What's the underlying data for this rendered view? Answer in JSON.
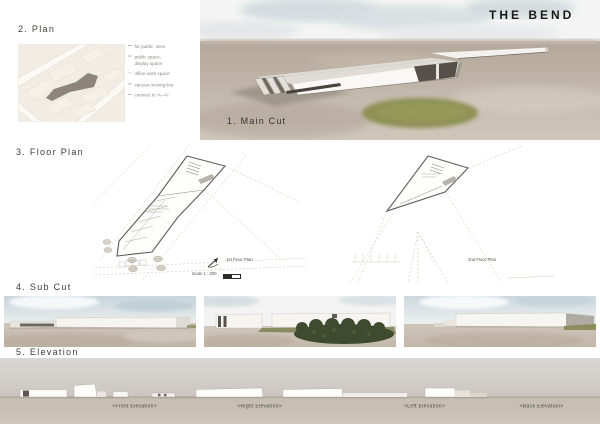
{
  "board_title": "THE BEND",
  "plan": {
    "heading": "2. Plan",
    "bullets": [
      "for public, semi",
      "public space, display space",
      "office work space",
      "various moving line",
      "connect to 'A—K'"
    ]
  },
  "main_cut": {
    "heading": "1. Main Cut"
  },
  "floor_plan": {
    "heading": "3. Floor Plan",
    "plan1_caption": "1st Floor Plan",
    "plan1_scale": "scale 1 : 300",
    "plan2_caption": "2nd Floor Plan"
  },
  "sub_cut": {
    "heading": "4. Sub Cut"
  },
  "elevation": {
    "heading": "5. Elevation",
    "captions": [
      "<Front Elevation>",
      "<Right Elevation>",
      "<Left Elevation>",
      "<Back Elevation>"
    ]
  },
  "colors": {
    "ground_taupe": "#bfb4a8",
    "sky_blue_gray": "#ccd6da",
    "lawn_green": "#8e9055",
    "bush_dark_green": "#3f4b2e",
    "map_cream": "#f2ede4",
    "footprint_gray": "#8d857c",
    "elevation_band": "#d4d0cb",
    "line_dark": "#5f5c55"
  }
}
